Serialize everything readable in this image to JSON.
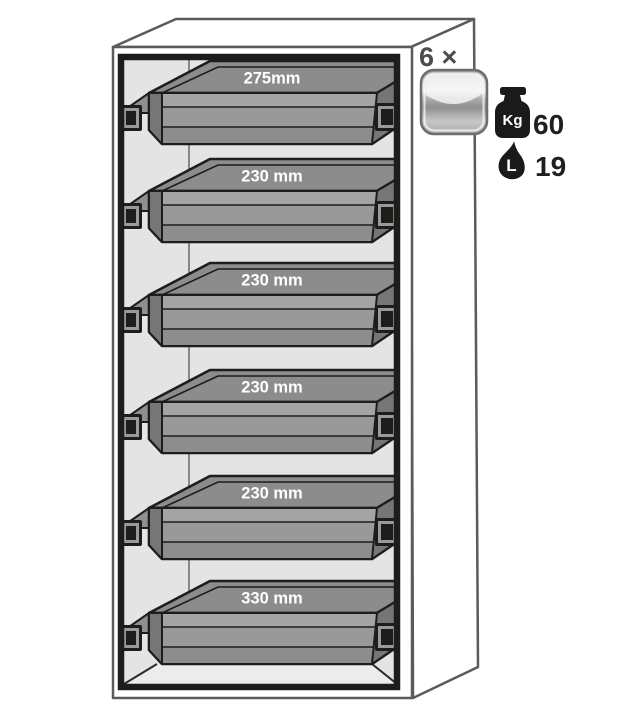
{
  "cabinet": {
    "name": "safety-cabinet-with-pullout-shelves",
    "shelves": [
      {
        "label": "275mm"
      },
      {
        "label": "230 mm"
      },
      {
        "label": "230 mm"
      },
      {
        "label": "230 mm"
      },
      {
        "label": "230 mm"
      },
      {
        "label": "330 mm"
      }
    ]
  },
  "legend": {
    "multiplier": "6 ×",
    "weight": {
      "unit": "Kg",
      "value": "60"
    },
    "volume": {
      "unit": "L",
      "value": "19"
    }
  },
  "icons": {
    "shelf_icon": "pull-out-shelf-icon",
    "weight_icon": "weight-kg-icon",
    "volume_icon": "liquid-drop-icon"
  },
  "colors": {
    "outline_dark": "#1d1d1b",
    "cabinet_line": "#5b5b5b",
    "interior_bg": "#e4e4e4",
    "shelf_top_gray": "#8c8c8c",
    "shelf_front_gray": "#999999",
    "shelf_end_gray": "#767676",
    "label_text": "#ffffff",
    "value_text": "#1f1f1f",
    "multiplier_text": "#4c4c4c"
  }
}
